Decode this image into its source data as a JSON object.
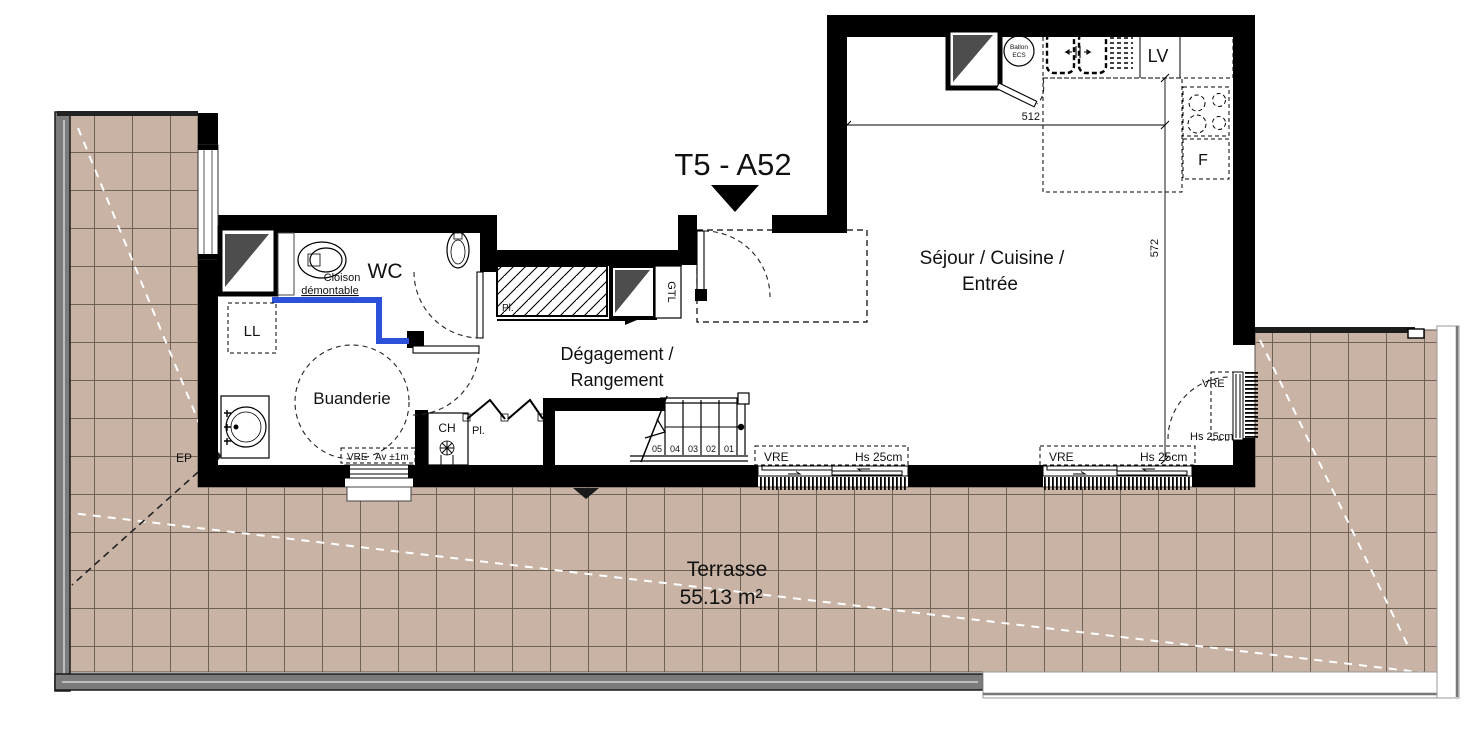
{
  "plan": {
    "title": "T5 - A52",
    "rooms": {
      "sejour_line1": "Séjour / Cuisine /",
      "sejour_line2": "Entrée",
      "degagement_line1": "Dégagement /",
      "degagement_line2": "Rangement",
      "buanderie": "Buanderie",
      "wc": "WC",
      "terrasse": "Terrasse",
      "terrasse_area": "55.13 m²"
    },
    "fixtures": {
      "washing_machine": "LL",
      "dishwasher": "LV",
      "fridge": "F",
      "boiler": "CH",
      "utility_duct": "GTL",
      "rain_pipe": "EP",
      "closet": "Pl.",
      "water_heater_line1": "Ballon",
      "water_heater_line2": "ECS"
    },
    "annotations": {
      "partition_line1": "Cloison",
      "partition_line2": "démontable",
      "window_tag": "VRE",
      "sill_height": "Hs 25cm",
      "window_adjust": "Av ±1m"
    },
    "dimensions": {
      "kitchen_width_cm": "512",
      "living_depth_cm": "572"
    },
    "stair_steps": [
      "05",
      "04",
      "03",
      "02",
      "01"
    ],
    "colors": {
      "wall": "#000000",
      "demountable_partition": "#2b50d9",
      "terrace_tile": "#c8b3a4",
      "tile_joint": "#6e6156",
      "railing_gray": "#7b7b7b"
    }
  }
}
